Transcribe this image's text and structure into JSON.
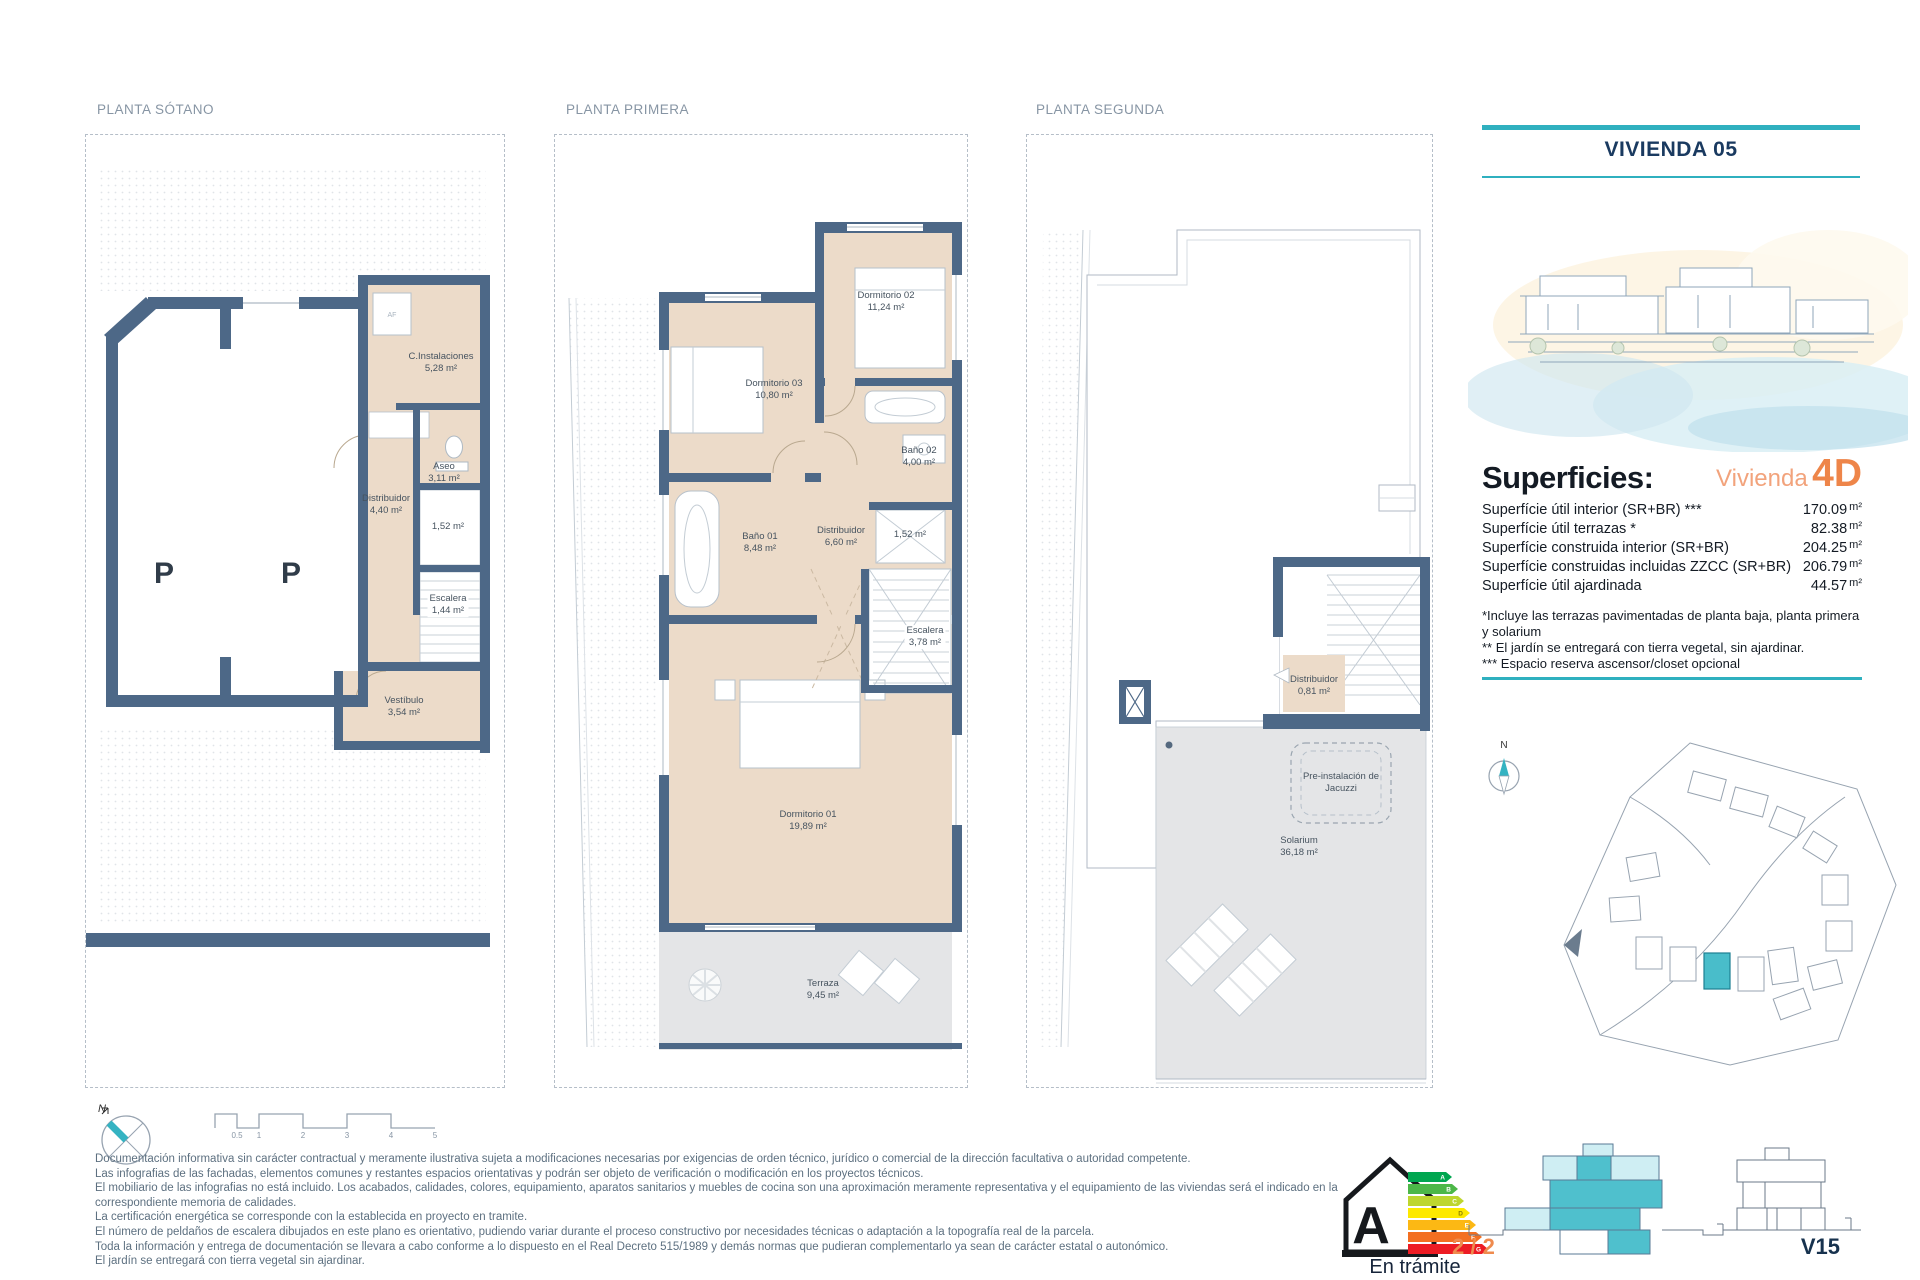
{
  "colors": {
    "teal": "#2FB0BF",
    "navy": "#1A3A60",
    "orange": "#EE8549",
    "orange_light": "#F2A37C",
    "wall": "#4D6887",
    "floor_beige": "#ECDBC9",
    "terrace_grey": "#E4E5E7",
    "title_grey": "#8795A4",
    "text_grey": "#5D7080",
    "ink": "#141B24"
  },
  "plans": [
    {
      "id": "sotano",
      "title": "PLANTA SÓTANO",
      "unit_label": "AF",
      "parking": [
        "P",
        "P"
      ],
      "rooms": [
        {
          "name": "C.Instalaciones",
          "area": "5,28 m²"
        },
        {
          "name": "Aseo",
          "area": "3,11 m²"
        },
        {
          "name": "Distribuidor",
          "area": "4,40 m²"
        },
        {
          "name": "",
          "area": "1,52 m²"
        },
        {
          "name": "Escalera",
          "area": "1,44 m²"
        },
        {
          "name": "Vestíbulo",
          "area": "3,54 m²"
        }
      ]
    },
    {
      "id": "primera",
      "title": "PLANTA PRIMERA",
      "rooms": [
        {
          "name": "Dormitorio 03",
          "area": "10,80 m²"
        },
        {
          "name": "Dormitorio 02",
          "area": "11,24 m²"
        },
        {
          "name": "Baño 02",
          "area": "4,00 m²"
        },
        {
          "name": "Baño 01",
          "area": "8,48 m²"
        },
        {
          "name": "Distribuidor",
          "area": "6,60 m²"
        },
        {
          "name": "",
          "area": "1,52 m²"
        },
        {
          "name": "Escalera",
          "area": "3,78 m²"
        },
        {
          "name": "Dormitorio 01",
          "area": "19,89 m²"
        },
        {
          "name": "Terraza",
          "area": "9,45 m²"
        }
      ]
    },
    {
      "id": "segunda",
      "title": "PLANTA SEGUNDA",
      "rooms": [
        {
          "name": "Distribuidor",
          "area": "0,81 m²"
        },
        {
          "name": "Pre-instalación de Jacuzzi",
          "area": ""
        },
        {
          "name": "Solarium",
          "area": "36,18 m²"
        }
      ]
    }
  ],
  "right_panel": {
    "title": "VIVIENDA 05",
    "compass_n": "N",
    "superficies": {
      "heading": "Superficies:",
      "vivienda_label": "Vivienda",
      "vivienda_type": "4D",
      "rows": [
        {
          "label": "Superfície útil interior (SR+BR) ***",
          "value": "170.09",
          "unit": "m²"
        },
        {
          "label": "Superfície útil terrazas *",
          "value": "82.38",
          "unit": "m²"
        },
        {
          "label": "Superfície construida interior (SR+BR)",
          "value": "204.25",
          "unit": "m²"
        },
        {
          "label": "Superfície construidas incluidas ZZCC (SR+BR)",
          "value": "206.79",
          "unit": "m²"
        },
        {
          "label": "Superfície útil ajardinada",
          "value": "44.57",
          "unit": "m²"
        }
      ],
      "notes": [
        "*Incluye las terrazas pavimentadas de planta baja, planta primera y solarium",
        "** El jardín se entregará con tierra vegetal, sin ajardinar.",
        "*** Espacio reserva ascensor/closet opcional"
      ]
    }
  },
  "footer": {
    "compass_n": "N",
    "scale_ticks": [
      "0.5",
      "1",
      "2",
      "3",
      "4",
      "5"
    ],
    "disclaimer": [
      "Documentación informativa sin carácter contractual y meramente ilustrativa sujeta a modificaciones necesarias por exigencias de orden técnico, jurídico o comercial de la dirección facultativa o autoridad competente.",
      "Las infografias de las fachadas, elementos comunes y restantes espacios orientativas y podrán ser objeto de verificación o modificación en los proyectos técnicos.",
      "El mobiliario de las infografias no está incluido. Los acabados, calidades, colores, equipamiento, aparatos sanitarios y muebles de cocina son una aproximación meramente representativa y el equipamiento de las viviendas será el indicado en la correspondiente memoria de calidades.",
      "La certificación energética se corresponde con la establecida en proyecto en tramite.",
      "El número de peldaños de escalera dibujados en este plano es orientativo, pudiendo variar durante el proceso constructivo por necesidades técnicas o adaptación a la topografía real de la parcela.",
      "Toda la información y entrega de documentación se llevara a cabo conforme a lo dispuesto en el Real Decreto 515/1989 y demás normas que pudieran complementarlo ya sean de carácter estatal o autonómico.",
      "El jardín se entregará con tierra vegetal sin ajardinar."
    ],
    "energy": {
      "letter": "A",
      "ratings": [
        "A",
        "B",
        "C",
        "D",
        "E",
        "F",
        "G"
      ],
      "status": "En trámite"
    },
    "page": "2 / 2",
    "sheet_code": "V15"
  }
}
